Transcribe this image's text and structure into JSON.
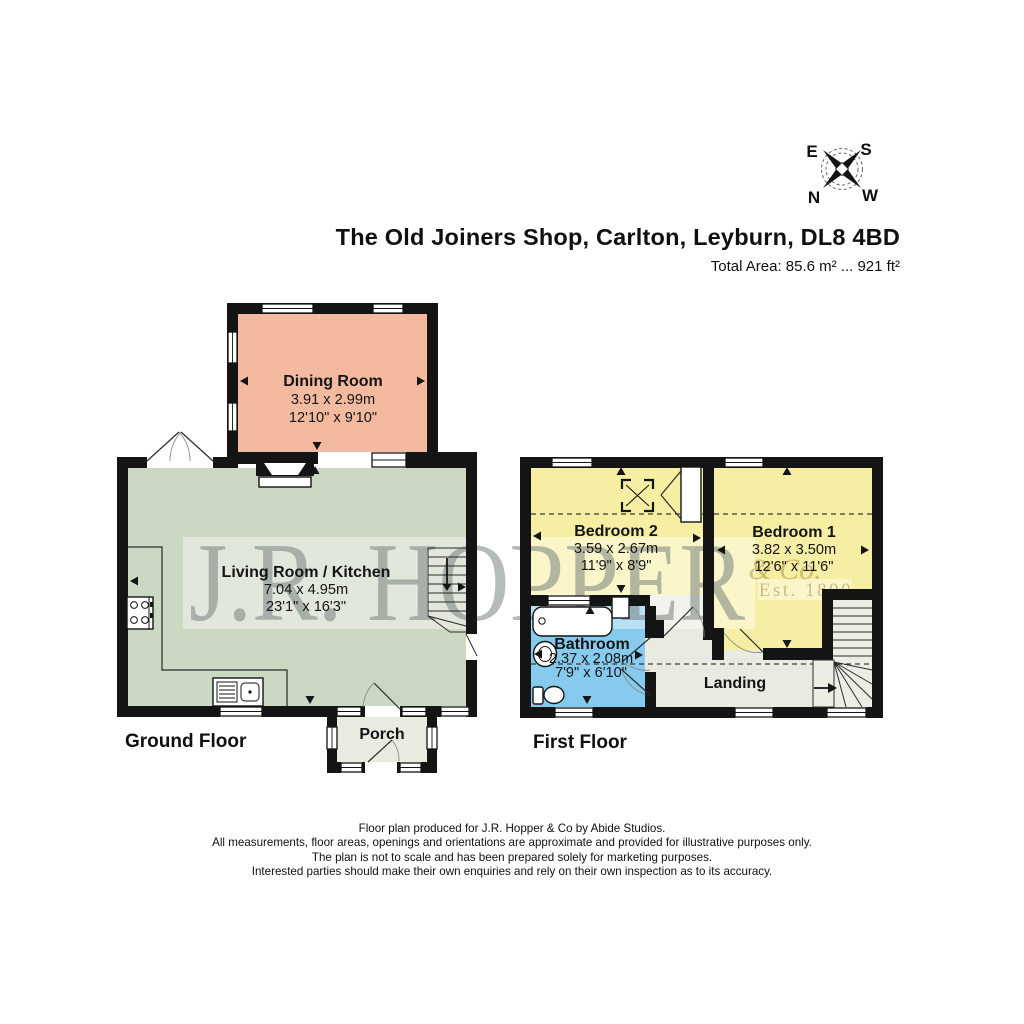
{
  "page": {
    "title": "The Old Joiners Shop, Carlton, Leyburn, DL8 4BD",
    "total_area": "Total Area: 85.6 m² ... 921 ft²"
  },
  "compass": {
    "east": "E",
    "south": "S",
    "north": "N",
    "west": "W"
  },
  "watermark": {
    "name": "J.R. HOPPER",
    "suffix": "& Co.",
    "established": "Est. 1890"
  },
  "colors": {
    "wall": "#141414",
    "dining": "#F3BA9F",
    "living": "#CBD8C2",
    "bedroom": "#F6EFA3",
    "bathroom": "#86CBEE",
    "hall": "#EAEAE1",
    "stairs": "#EDEDE6"
  },
  "floors": {
    "ground": {
      "label": "Ground Floor",
      "rooms": {
        "dining": {
          "name": "Dining Room",
          "metric": "3.91 x 2.99m",
          "imperial": "12'10\" x 9'10\""
        },
        "living": {
          "name": "Living Room / Kitchen",
          "metric": "7.04 x 4.95m",
          "imperial": "23'1\" x 16'3\""
        },
        "porch": {
          "name": "Porch"
        }
      }
    },
    "first": {
      "label": "First Floor",
      "rooms": {
        "bedroom2": {
          "name": "Bedroom 2",
          "metric": "3.59 x 2.67m",
          "imperial": "11'9\" x 8'9\""
        },
        "bedroom1": {
          "name": "Bedroom 1",
          "metric": "3.82 x 3.50m",
          "imperial": "12'6\" x 11'6\""
        },
        "bathroom": {
          "name": "Bathroom",
          "metric": "2.37 x 2.08m",
          "imperial": "7'9\" x 6'10\""
        },
        "landing": {
          "name": "Landing"
        }
      }
    }
  },
  "footer": {
    "lines": [
      "Floor plan produced for J.R. Hopper & Co by Abide Studios.",
      "All measurements, floor areas, openings and orientations are approximate and provided for illustrative purposes only.",
      "The plan is not to scale and has been prepared solely for marketing purposes.",
      "Interested parties should make their own enquiries and rely on their own inspection as to its accuracy."
    ]
  }
}
